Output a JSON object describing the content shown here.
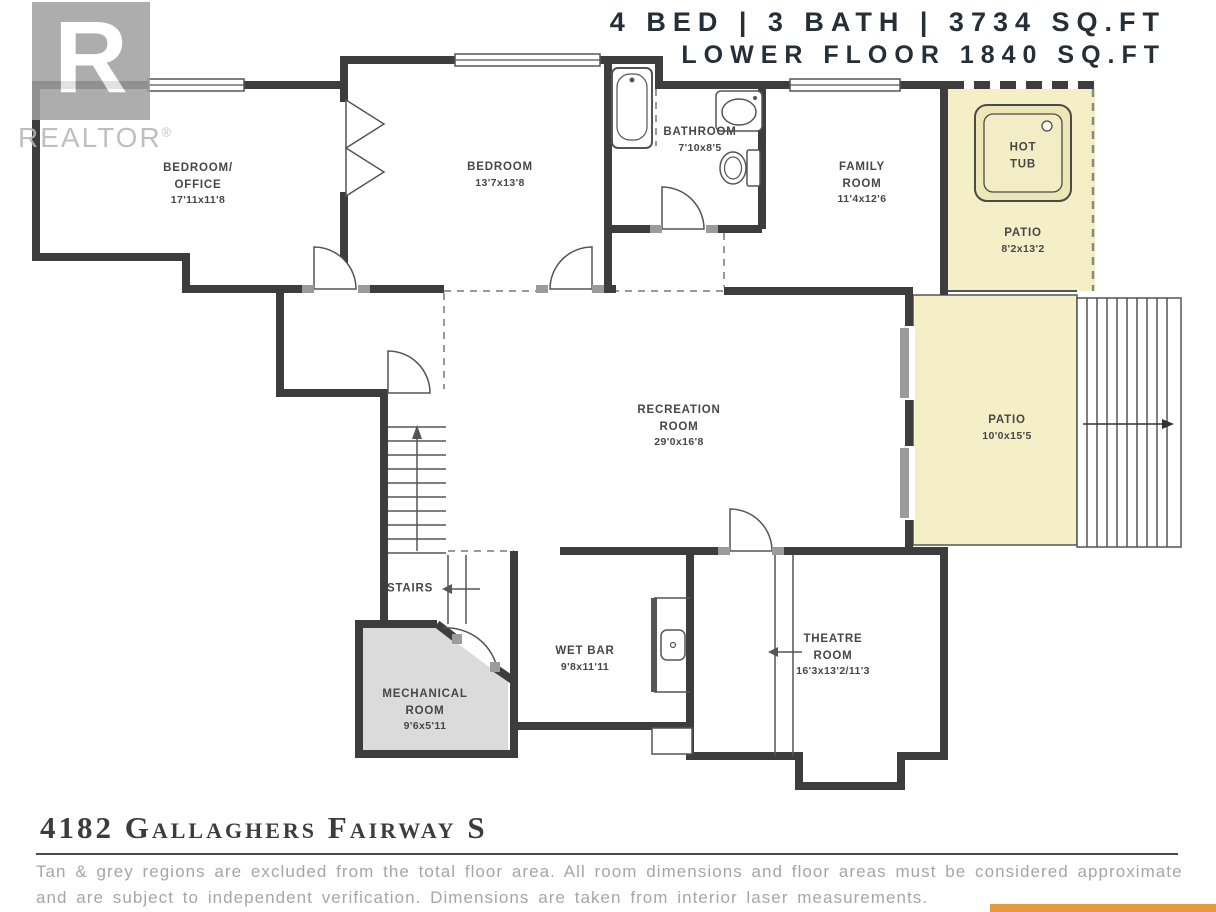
{
  "header": {
    "line1": "4 BED | 3 BATH | 3734 SQ.FT",
    "line2": "LOWER FLOOR 1840 SQ.FT"
  },
  "logo": {
    "brand": "REALTOR",
    "reg": "®"
  },
  "rooms": {
    "bedroom_office": {
      "name": "BEDROOM/\nOFFICE",
      "dims": "17'11x11'8"
    },
    "bedroom": {
      "name": "BEDROOM",
      "dims": "13'7x13'8"
    },
    "bathroom": {
      "name": "BATHROOM",
      "dims": "7'10x8'5"
    },
    "family_room": {
      "name": "FAMILY\nROOM",
      "dims": "11'4x12'6"
    },
    "hot_tub": {
      "name": "HOT\nTUB",
      "dims": ""
    },
    "patio_upper": {
      "name": "PATIO",
      "dims": "8'2x13'2"
    },
    "recreation_room": {
      "name": "RECREATION\nROOM",
      "dims": "29'0x16'8"
    },
    "patio_lower": {
      "name": "PATIO",
      "dims": "10'0x15'5"
    },
    "stairs": {
      "name": "STAIRS",
      "dims": ""
    },
    "wet_bar": {
      "name": "WET BAR",
      "dims": "9'8x11'11"
    },
    "mechanical_room": {
      "name": "MECHANICAL\nROOM",
      "dims": "9'6x5'11"
    },
    "theatre_room": {
      "name": "THEATRE\nROOM",
      "dims": "16'3x13'2/11'3"
    }
  },
  "footer": {
    "address": "4182 Gallaghers Fairway S",
    "disclaimer_line1": "Tan & grey regions are excluded from the total floor area. All room dimensions and floor areas must be considered approximate",
    "disclaimer_line2": "and are subject to independent verification. Dimensions are taken from interior laser measurements."
  },
  "colors": {
    "wall": "#3d3d3d",
    "patio_tan": "#F4EFC7",
    "mechanical_grey": "#DBDBDB",
    "accent_orange": "#E79A3B"
  }
}
